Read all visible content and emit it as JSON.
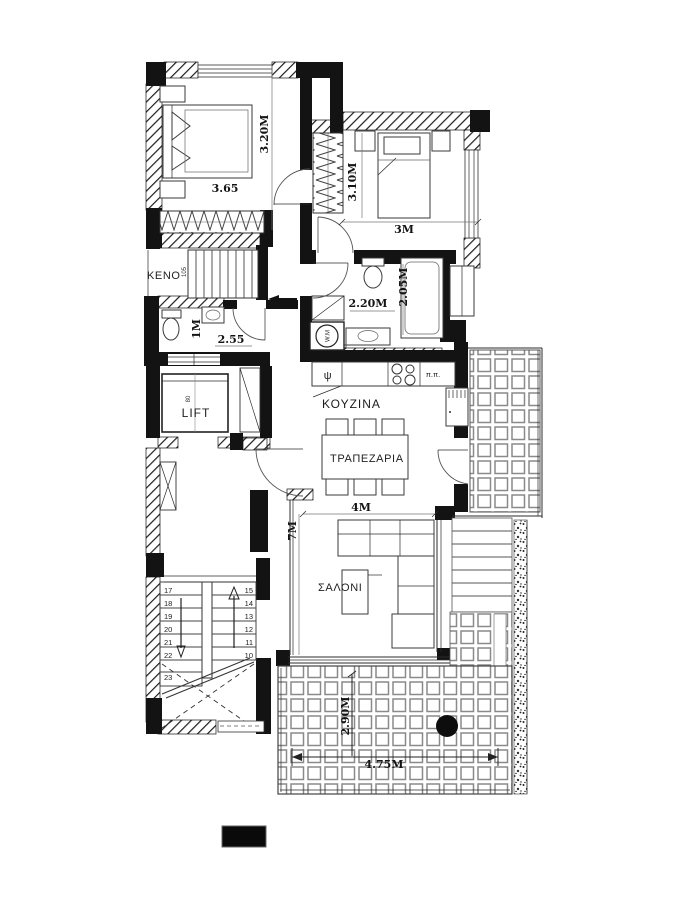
{
  "plan": {
    "bedroom1": {
      "width_label": "3.65",
      "height_label": "3.20M"
    },
    "bedroom2": {
      "width_label": "3M",
      "height_label": "3.10M"
    },
    "keno": {
      "label": "KENO",
      "riser_note": "105"
    },
    "wc": {
      "width_label": "2.55",
      "height_label": "1M"
    },
    "bathroom": {
      "width_label": "2.20M",
      "height_label": "2.05M"
    },
    "laundry": {
      "label": "W.M"
    },
    "lift": {
      "label": "LIFT",
      "door_note": "80"
    },
    "kitchen": {
      "label": "ΚΟΥΖΙΝΑ",
      "sink_label": "ψ",
      "hob_label": "π.π."
    },
    "dining": {
      "label": "ΤΡΑΠΕΖΑΡΙΑ"
    },
    "hall": {
      "width_label": "4M",
      "height_label": "7M"
    },
    "living": {
      "label": "ΣΑΛΟΝΙ"
    },
    "terrace": {
      "width_label": "4.75M",
      "depth_label": "2.90M"
    },
    "stairs_lower": {
      "left_steps": [
        "17",
        "18",
        "19",
        "20",
        "21",
        "22",
        "23"
      ],
      "right_steps": [
        "15",
        "14",
        "13",
        "12",
        "11",
        "10"
      ]
    }
  },
  "colors": {
    "wall": "#131313",
    "line": "#2b2b2b",
    "tile_joint": "#8a8a8a",
    "background": "#ffffff"
  }
}
